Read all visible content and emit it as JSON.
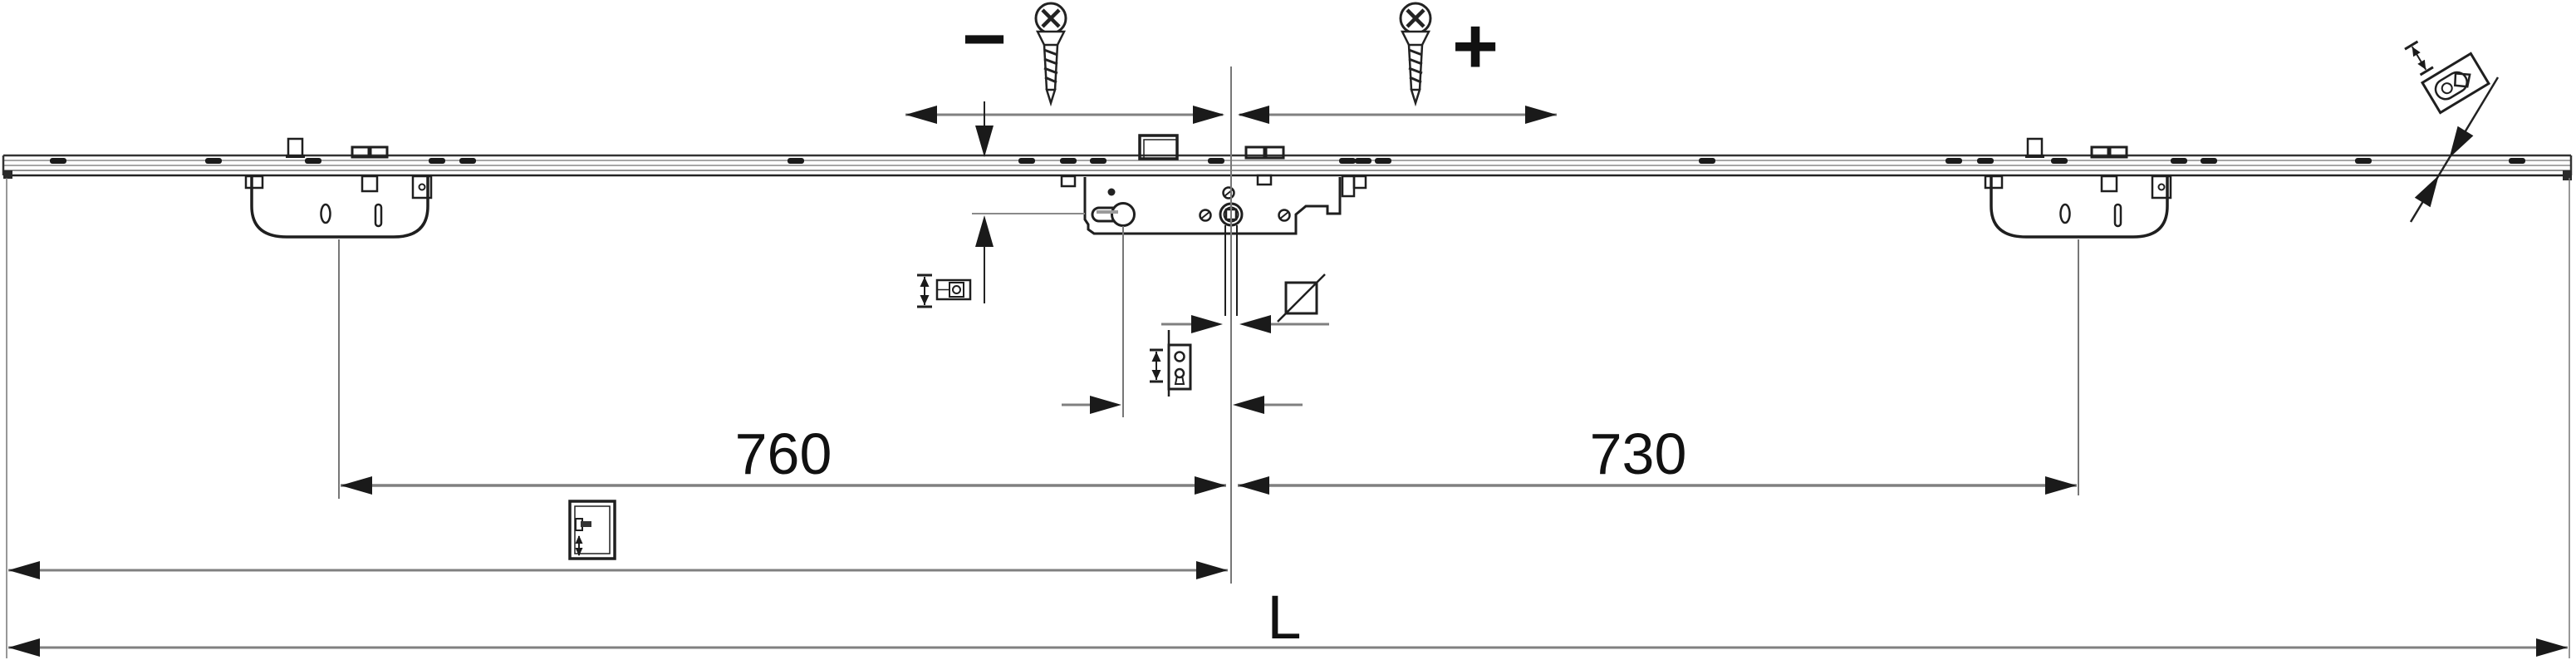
{
  "drawing": {
    "title": "Multi-point lock espagnolette dimension drawing",
    "background_color": "#ffffff",
    "line_color": "#1f1f1f",
    "dimension_line_color": "#7f7f7f"
  },
  "adjustment_indicator": {
    "minus_label": "−",
    "plus_label": "+",
    "left_screw_icon": "countersunk-screw-icon",
    "right_screw_icon": "countersunk-screw-icon"
  },
  "dimensions": {
    "left_case_to_center": {
      "value": "760"
    },
    "center_to_right_case": {
      "value": "730"
    },
    "total_length_label": {
      "value": "L"
    }
  },
  "components": {
    "rail": "face-plate rail with oblong screw slots",
    "left_lock_case": "auxiliary lock case",
    "right_lock_case": "auxiliary lock case",
    "gearbox": "central gearbox with euro cylinder hole and follower hub",
    "latch_block": "latch bolt on face plate",
    "spindle": "handle spindle axis"
  },
  "icons": [
    "countersunk-screw-icon",
    "minus-sign",
    "plus-sign",
    "cam-height-adjust-icon",
    "square-spindle-icon",
    "faceplate-adjust-icon",
    "handle-height-door-icon",
    "cam-projection-detail-icon"
  ]
}
